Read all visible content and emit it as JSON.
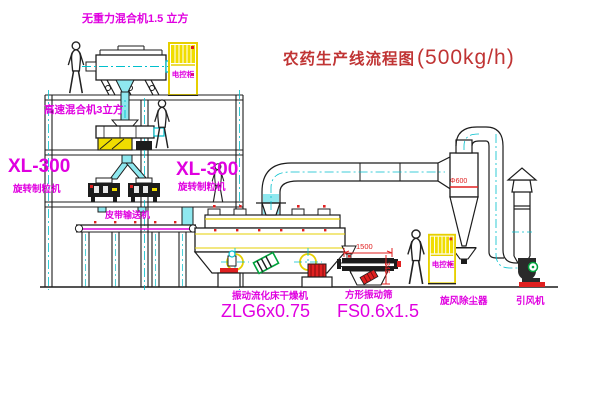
{
  "title": {
    "text": "农药生产线流程图",
    "capacity": "(500kg/h)"
  },
  "labels": {
    "top_mixer": "无重力混合机1.5 立方",
    "floor2_mixer": "高速混合机3立方",
    "left_model": "XL-300",
    "left_name": "旋转制粒机",
    "mid_model": "XL-300",
    "mid_name": "旋转制粒机",
    "conveyor": "皮带输送机",
    "dryer_name": "振动流化床干燥机",
    "dryer_model": "ZLG6x0.75",
    "sieve_name": "方形振动筛",
    "sieve_model": "FS0.6x1.5",
    "cyclone": "旋风除尘器",
    "fan": "引风机",
    "cabinet1": "电控柜",
    "cabinet2": "电控柜"
  },
  "dimensions": {
    "cyclone_diameter": "Φ600",
    "sieve_width": "1500",
    "sieve_height": "345"
  },
  "colors": {
    "label_magenta": "#e000e0",
    "title_red": "#c03434",
    "dimension_red": "#e02020",
    "centerline_cyan": "#00bfcc",
    "structure_dark": "#1c1c1c",
    "equipment_yellow": "#e6cf00",
    "motor_red": "#e02020",
    "motor_green": "#00a33c"
  },
  "icons": {
    "person_figures": 4
  }
}
